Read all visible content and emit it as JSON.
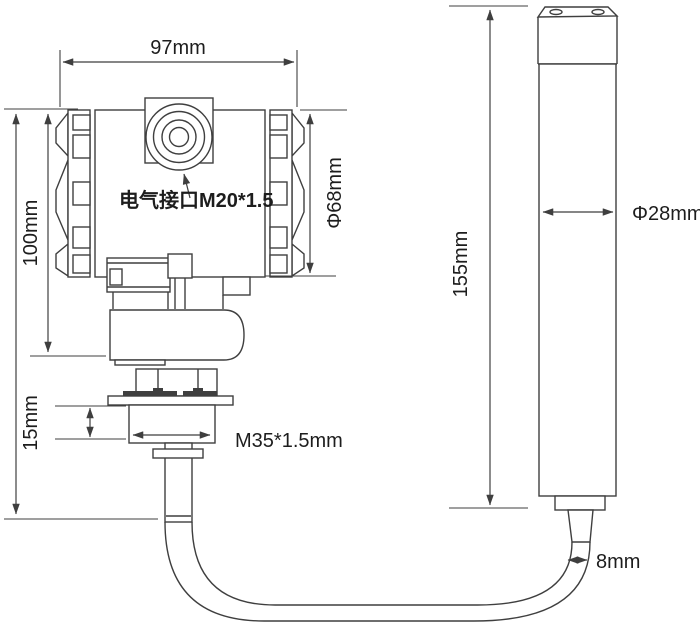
{
  "diagram": {
    "kind": "pressure-level-transmitter-dimension-drawing",
    "labels": {
      "housing_width": "97mm",
      "housing_height": "100mm",
      "electrical_port": "电气接口M20*1.5",
      "housing_diameter": "Φ68mm",
      "nut_height": "15mm",
      "thread_spec": "M35*1.5mm",
      "probe_length": "155mm",
      "probe_diameter": "Φ28mm",
      "cable_diameter": "8mm"
    },
    "colors": {
      "line": "#3f3f3f",
      "text": "#1d1d1d",
      "background": "#ffffff"
    }
  }
}
